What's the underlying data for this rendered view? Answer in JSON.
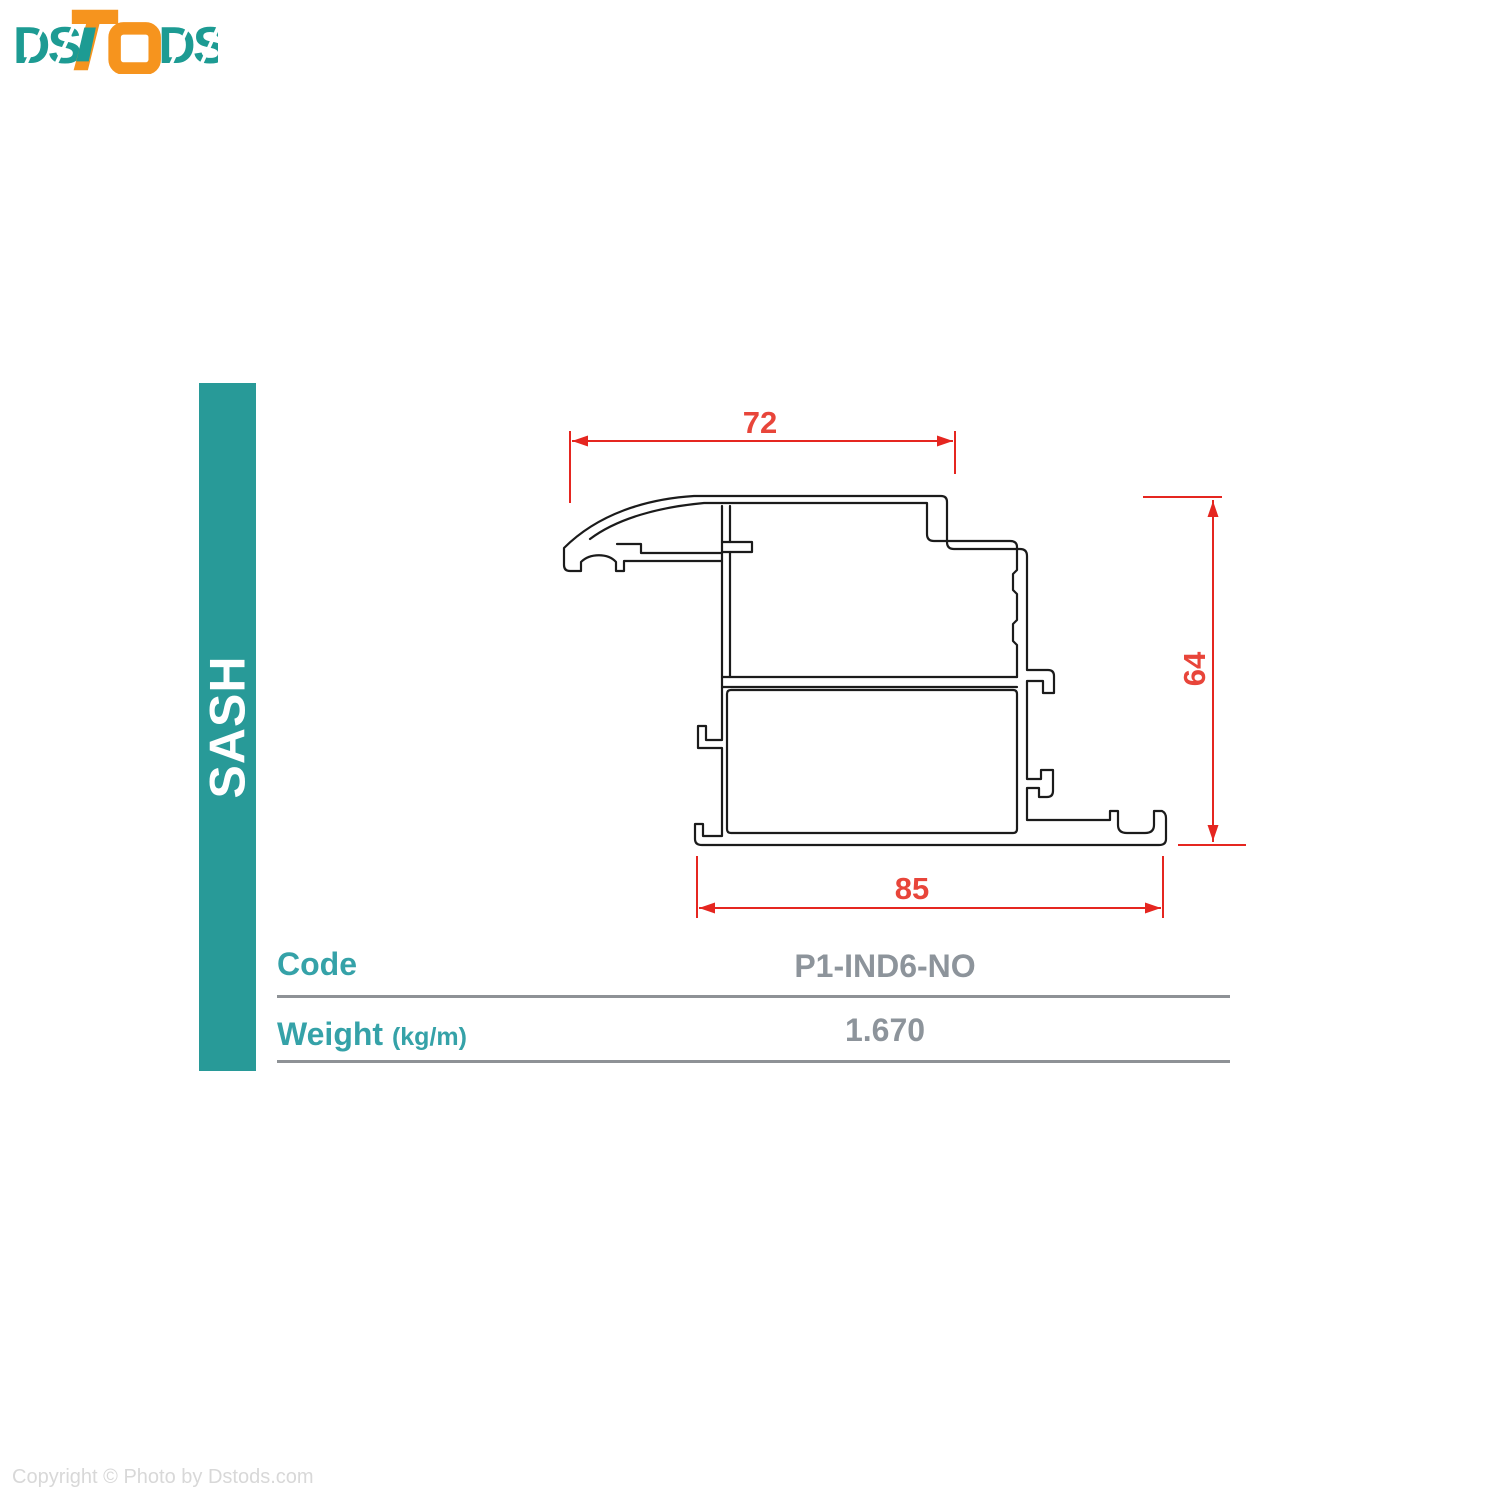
{
  "logo": {
    "ds_left": "DS",
    "ds_right": "DS",
    "teal_color": "#1d9b93",
    "orange_color": "#f6941e"
  },
  "sidebar": {
    "label": "SASH",
    "color": "#289a98"
  },
  "drawing": {
    "type": "profile-cross-section",
    "dim_top_width": "72",
    "dim_bottom_width": "85",
    "dim_right_height": "64",
    "dimension_color": "#e52620",
    "outline_color": "#1b1b1b"
  },
  "table": {
    "rows": [
      {
        "label": "Code",
        "unit": "",
        "value": "P1-IND6-NO"
      },
      {
        "label": "Weight",
        "unit": "(kg/m)",
        "value": "1.670"
      }
    ]
  },
  "footer": {
    "copyright": "Copyright © Photo by Dstods.com"
  }
}
